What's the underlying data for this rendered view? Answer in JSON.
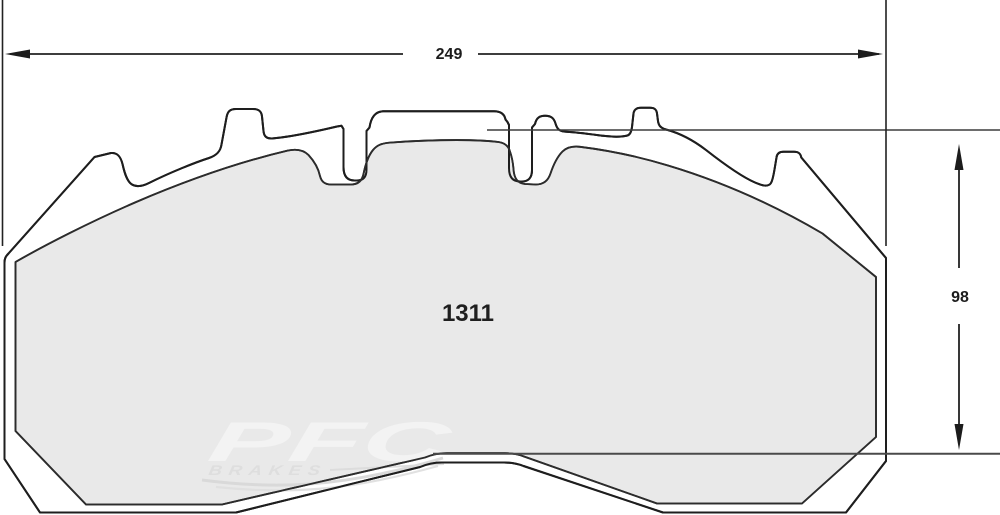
{
  "drawing": {
    "part_number": "1311",
    "dimensions": {
      "width_label": "249",
      "height_label": "98"
    },
    "watermark": {
      "brand": "PFC",
      "brand_sub": "BRAKES"
    },
    "colors": {
      "outline": "#1e1e1e",
      "friction_outline": "#2c2c2c",
      "plate_fill": "#ffffff",
      "friction_fill": "#e9e9e9",
      "dimension_line": "#2a2a2a",
      "reference_line": "#3d3d3d",
      "watermark_light": "#f4f4f4",
      "watermark_gray": "#dedede",
      "watermark_swoosh": "#d9d9d9"
    }
  }
}
